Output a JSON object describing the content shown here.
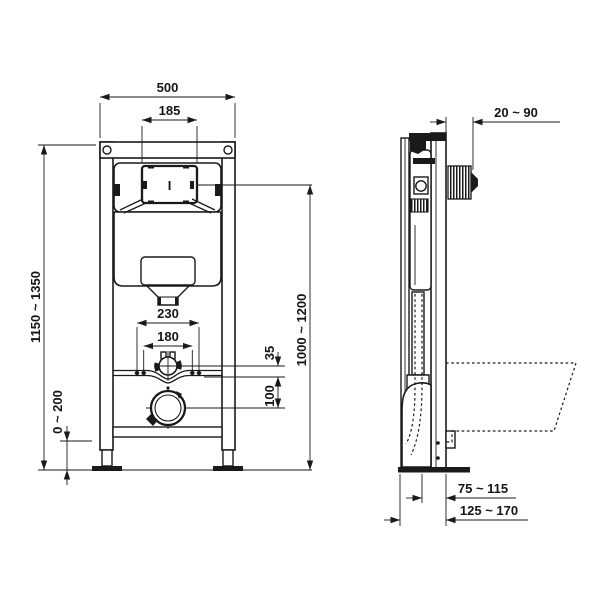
{
  "meta": {
    "background_color": "#ffffff",
    "line_color": "#1a1a1a",
    "description": "Technical installation drawing of a wall-hung WC concealed-cistern frame, front and side elevations with dimensions in mm"
  },
  "front_view": {
    "label": "front-elevation",
    "flush_plate_mark": "I",
    "dims": {
      "frame_width": "500",
      "flush_plate_width": "185",
      "frame_height_range": "1150 ~ 1350",
      "foot_adjust_range": "0 ~ 200",
      "fixing_bolt_spacing_outer": "230",
      "fixing_bolt_spacing_inner": "180",
      "flush_pipe_offset": "35",
      "outlet_offset": "100",
      "plate_height_range": "1000 ~ 1200"
    }
  },
  "side_view": {
    "label": "side-elevation",
    "dims": {
      "flush_bend_protrusion": "20 ~ 90",
      "outlet_to_frame_front": "75 ~ 115",
      "wall_to_frame_front": "125 ~ 170"
    }
  }
}
